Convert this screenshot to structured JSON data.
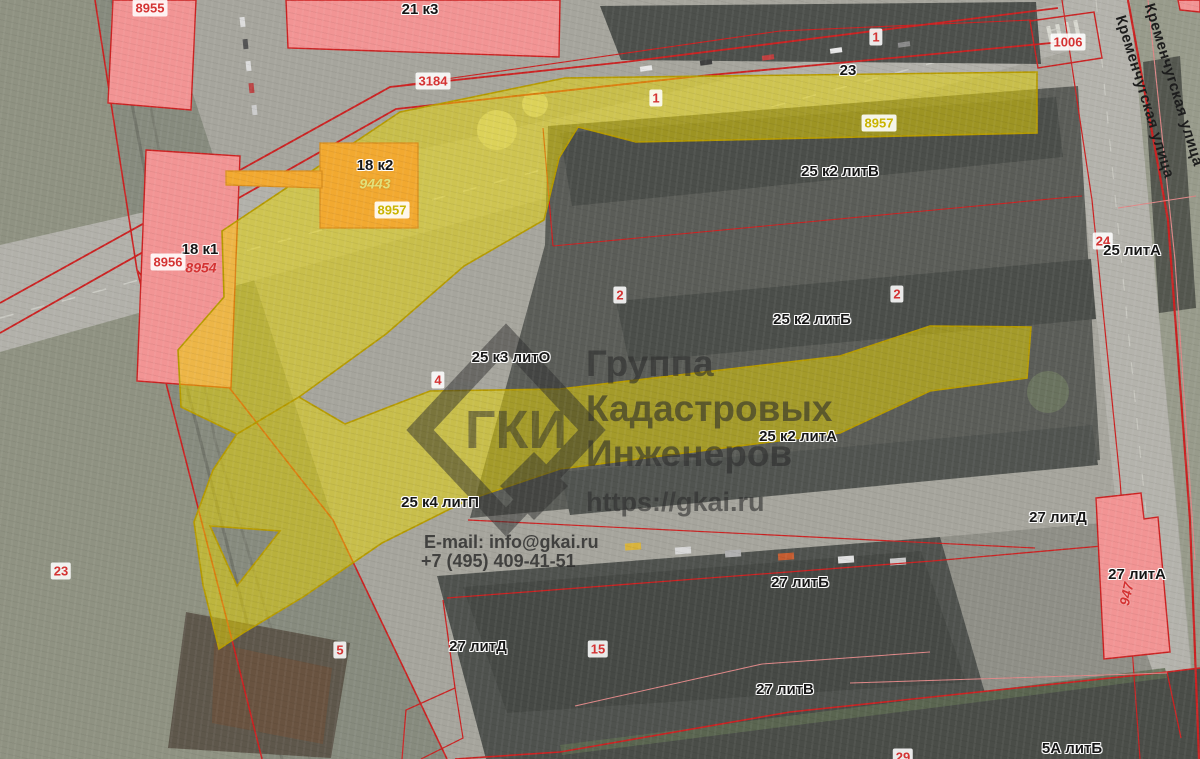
{
  "watermark": {
    "logo_text": "ГКИ",
    "org_line1": "Группа",
    "org_line2": "Кадастровых",
    "org_line3": "Инженеров",
    "url": "https://gkai.ru",
    "email": "E-mail: info@gkai.ru",
    "phone": "+7 (495) 409-41-51"
  },
  "colors": {
    "highlight_yellow": "#e8d400",
    "highlight_border": "#b69b00",
    "building_pink": "#f29494",
    "building_orange": "#f2a930",
    "parcel_line_red": "#cc2222",
    "cadastral_text_red": "#d43333",
    "cadastral_text_yellow": "#c9b400",
    "watermark_gray": "#2e2e2e"
  },
  "map": {
    "labels": [
      {
        "text": "8955",
        "x": 150,
        "y": 8,
        "type": "badge"
      },
      {
        "text": "21 к3",
        "x": 420,
        "y": 10,
        "type": "name"
      },
      {
        "text": "3184",
        "x": 433,
        "y": 81,
        "type": "badge"
      },
      {
        "text": "1",
        "x": 656,
        "y": 98,
        "type": "badge"
      },
      {
        "text": "23",
        "x": 848,
        "y": 71,
        "type": "name"
      },
      {
        "text": "1",
        "x": 876,
        "y": 37,
        "type": "badge"
      },
      {
        "text": "1006",
        "x": 1068,
        "y": 42,
        "type": "badge"
      },
      {
        "text": "8957",
        "x": 879,
        "y": 123,
        "type": "badge-y"
      },
      {
        "text": "18 к2",
        "x": 375,
        "y": 166,
        "type": "name"
      },
      {
        "text": "9443",
        "x": 375,
        "y": 184,
        "type": "italic-yellow"
      },
      {
        "text": "8957",
        "x": 392,
        "y": 210,
        "type": "badge-y"
      },
      {
        "text": "25 к2 литВ",
        "x": 840,
        "y": 172,
        "type": "name"
      },
      {
        "text": "18 к1",
        "x": 200,
        "y": 250,
        "type": "name"
      },
      {
        "text": "8956",
        "x": 168,
        "y": 262,
        "type": "badge"
      },
      {
        "text": "8954",
        "x": 201,
        "y": 268,
        "type": "italic-red"
      },
      {
        "text": "2",
        "x": 620,
        "y": 295,
        "type": "badge"
      },
      {
        "text": "2",
        "x": 897,
        "y": 294,
        "type": "badge"
      },
      {
        "text": "25 к2 литБ",
        "x": 812,
        "y": 320,
        "type": "name"
      },
      {
        "text": "24",
        "x": 1103,
        "y": 241,
        "type": "badge"
      },
      {
        "text": "25 литА",
        "x": 1132,
        "y": 251,
        "type": "name"
      },
      {
        "text": "25 к3 литО",
        "x": 511,
        "y": 358,
        "type": "name"
      },
      {
        "text": "4",
        "x": 438,
        "y": 380,
        "type": "badge"
      },
      {
        "text": "25 к2 литА",
        "x": 798,
        "y": 437,
        "type": "name"
      },
      {
        "text": "25 к4 литП",
        "x": 440,
        "y": 503,
        "type": "name"
      },
      {
        "text": "27 литД",
        "x": 1058,
        "y": 518,
        "type": "name"
      },
      {
        "text": "27 литА",
        "x": 1137,
        "y": 575,
        "type": "name"
      },
      {
        "text": "947",
        "x": 1127,
        "y": 594,
        "type": "italic-red",
        "rot": -78
      },
      {
        "text": "23",
        "x": 61,
        "y": 571,
        "type": "badge"
      },
      {
        "text": "27 литБ",
        "x": 800,
        "y": 583,
        "type": "name"
      },
      {
        "text": "15",
        "x": 598,
        "y": 649,
        "type": "badge"
      },
      {
        "text": "27 литД",
        "x": 478,
        "y": 647,
        "type": "name"
      },
      {
        "text": "5",
        "x": 340,
        "y": 650,
        "type": "badge"
      },
      {
        "text": "27 литВ",
        "x": 785,
        "y": 690,
        "type": "name"
      },
      {
        "text": "5А литБ",
        "x": 1072,
        "y": 749,
        "type": "name"
      },
      {
        "text": "29",
        "x": 903,
        "y": 757,
        "type": "badge"
      },
      {
        "text": "Кременчугская улица",
        "x": 1173,
        "y": 85,
        "type": "street",
        "rot": 73
      },
      {
        "text": "Кременчугская улица",
        "x": 1144,
        "y": 97,
        "type": "street",
        "rot": 73
      }
    ]
  }
}
